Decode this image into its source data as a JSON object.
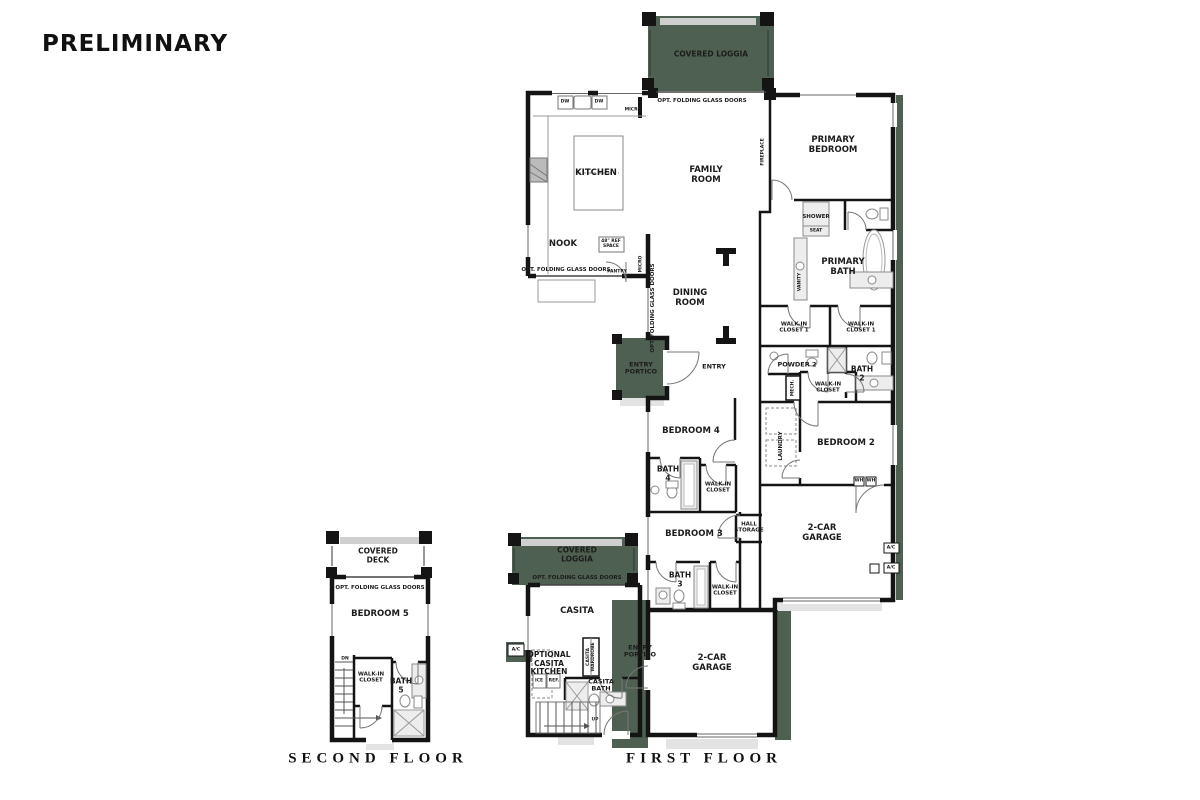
{
  "page": {
    "title": "PRELIMINARY",
    "second_floor_caption": "SECOND FLOOR",
    "first_floor_caption": "FIRST FLOOR"
  },
  "colors": {
    "covered_area_green": "#4e6052",
    "wall_black": "#141414",
    "fixture_gray": "#ededed",
    "driveway_gray": "#e3e3e3",
    "text_black": "#1c1c1c",
    "background": "#ffffff"
  },
  "labels": {
    "covered_loggia": "COVERED LOGGIA",
    "covered_deck": "COVERED DECK",
    "opt_folding_glass_doors": "OPT. FOLDING GLASS DOORS",
    "kitchen": "KITCHEN",
    "nook": "NOOK",
    "pantry": "PANTRY",
    "micro": "MICRO",
    "dw": "DW",
    "ref_space_48": "48\" REF SPACE",
    "family_room": "FAMILY ROOM",
    "fireplace": "FIREPLACE",
    "dining_room": "DINING ROOM",
    "entry": "ENTRY",
    "entry_portico": "ENTRY PORTICO",
    "primary_bedroom": "PRIMARY BEDROOM",
    "primary_bath": "PRIMARY BATH",
    "shower": "SHOWER",
    "seat": "SEAT",
    "vanity": "VANITY",
    "walk_in_closet_1": "WALK-IN CLOSET 1",
    "walk_in_closet": "WALK-IN CLOSET",
    "powder_2": "POWDER 2",
    "bath_2": "BATH 2",
    "bath_3": "BATH 3",
    "bath_4": "BATH 4",
    "bath_5": "BATH 5",
    "mech": "MECH.",
    "laundry": "LAUNDRY",
    "wh": "WH",
    "bedroom_2": "BEDROOM 2",
    "bedroom_3": "BEDROOM 3",
    "bedroom_4": "BEDROOM 4",
    "bedroom_5": "BEDROOM 5",
    "hall_storage": "HALL STORAGE",
    "two_car_garage": "2-CAR GARAGE",
    "ac": "A/C",
    "casita": "CASITA",
    "optional_casita_kitchen": "OPTIONAL CASITA KITCHEN",
    "casita_bath": "CASITA BATH",
    "casita_wardrobe": "CASITA WARDROBE",
    "ice": "ICE",
    "ref": "REF.",
    "up": "UP",
    "dn": "DN"
  }
}
